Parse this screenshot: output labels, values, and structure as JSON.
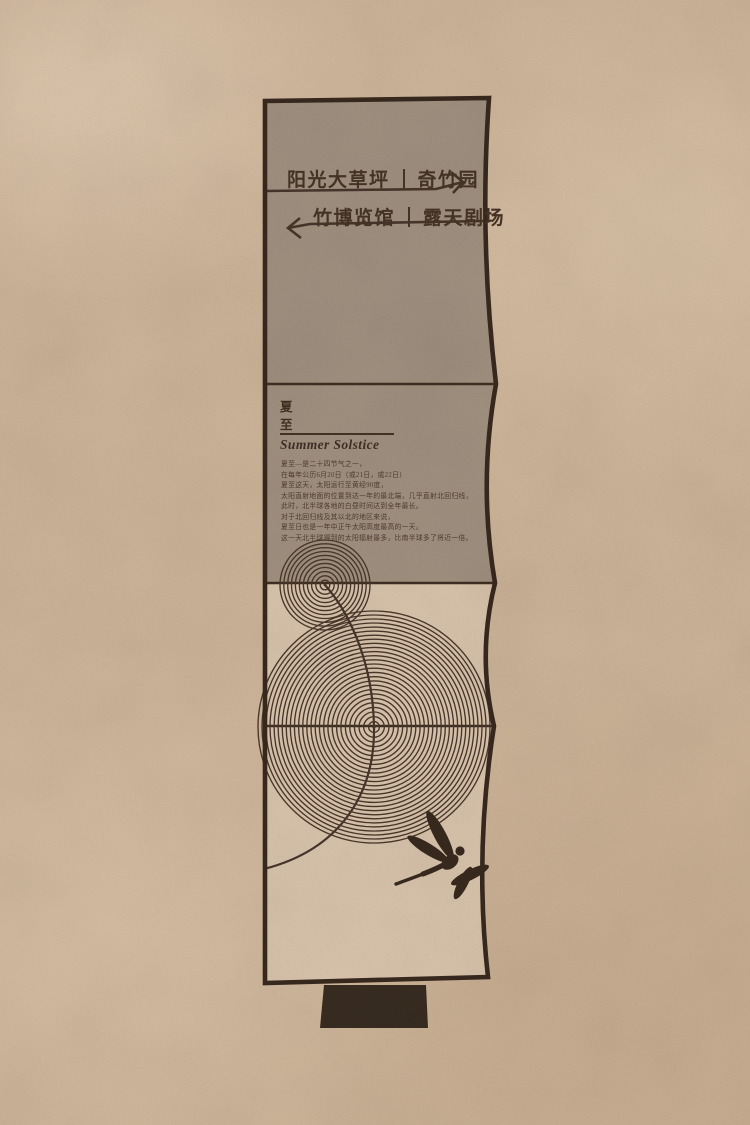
{
  "sign": {
    "directions": [
      {
        "left": "阳光大草坪",
        "right": "奇竹园",
        "arrow": "right"
      },
      {
        "left": "竹博览馆",
        "right": "露天剧场",
        "arrow": "left"
      }
    ],
    "solar_term": {
      "cn": "夏至",
      "en": "Summer Solstice",
      "paragraph": [
        "夏至—是二十四节气之一，",
        "在每年公历6月20日（或21日，或22日）",
        "夏至这天，太阳运行至黄经90度，",
        "太阳直射地面的位置到达一年的最北端，几乎直射北回归线，",
        "此时，北半球各地的白昼时间达到全年最长。",
        "对于北回归线及其以北的地区来说，",
        "夏至日也是一年中正午太阳高度最高的一天。",
        "这一天北半球得到的太阳辐射最多，比南半球多了将近一倍。"
      ]
    }
  },
  "colors": {
    "paper": "#cdb499",
    "panel_top": "#a09080",
    "panel_bottom": "#d9c4ac",
    "ink": "#46352a",
    "border": "#38291e",
    "base": "#382c21"
  }
}
